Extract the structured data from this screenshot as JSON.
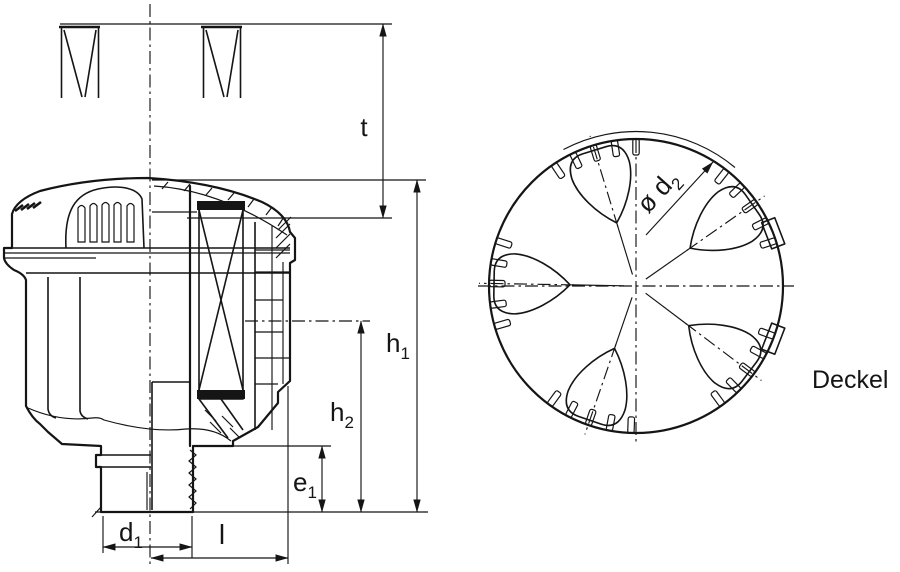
{
  "drawing": {
    "description": "Technical sectional drawing of an air filter housing with dimension callouts and a top view of the cover",
    "colors": {
      "housing_fill": "#a9ccb1",
      "line": "#151515",
      "background": "#ffffff"
    }
  },
  "labels": {
    "t": {
      "base": "t",
      "sub": ""
    },
    "h1": {
      "base": "h",
      "sub": "1"
    },
    "h2": {
      "base": "h",
      "sub": "2"
    },
    "e1": {
      "base": "e",
      "sub": "1"
    },
    "d1": {
      "base": "d",
      "sub": "1"
    },
    "l": {
      "base": "l",
      "sub": ""
    },
    "d2": {
      "base": "ø d",
      "sub": "2"
    },
    "deckel": "Deckel"
  }
}
